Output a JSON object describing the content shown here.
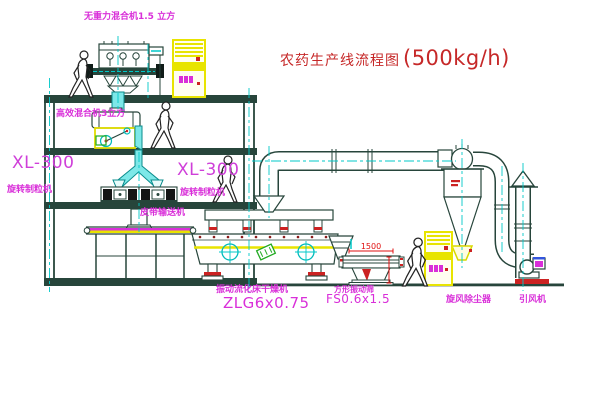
{
  "title": {
    "name": "农药生产线流程图",
    "capacity": "(500kg/h)"
  },
  "labels": {
    "mixer_top": "无重力混合机1.5 立方",
    "mixer_mid": "高效混合机3立方",
    "granulator_left_model": "XL-300",
    "granulator_left_name": "旋转制粒机",
    "granulator_right_model": "XL-300",
    "granulator_right_name": "旋转制粒机",
    "belt_conveyor": "皮带输送机",
    "dryer_name": "振动流化床干燥机",
    "dryer_model": "ZLG6x0.75",
    "screen_name": "方形振动筛",
    "screen_model": "FS0.6x1.5",
    "cyclone": "旋风除尘器",
    "fan": "引风机"
  },
  "dimensions": {
    "screen_length": "1500"
  },
  "palette": {
    "label_magenta": "#d92fd9",
    "title_red": "#c62828",
    "centerline_cyan": "#00c8c8",
    "structure_green": "#27453b",
    "machine_yellow": "#e8e400",
    "accent_red": "#cc2222",
    "chute_cyan": "#7de8e8"
  }
}
